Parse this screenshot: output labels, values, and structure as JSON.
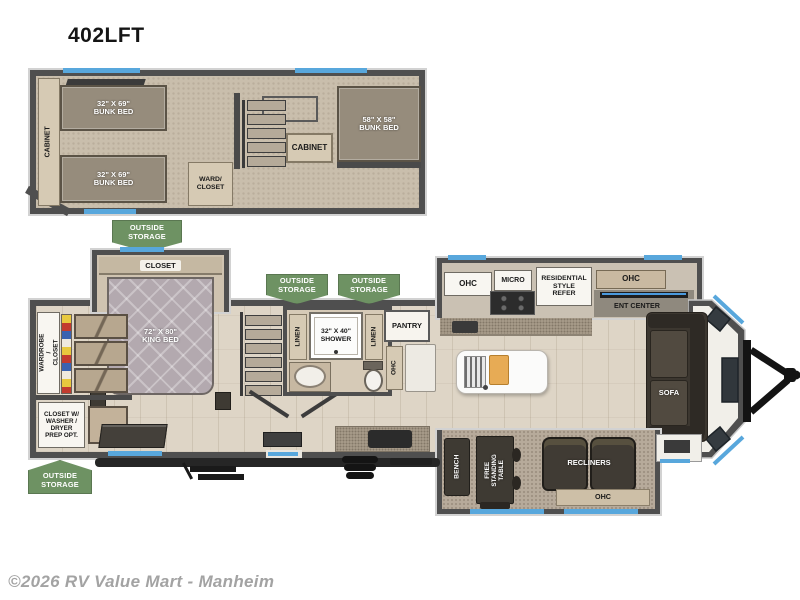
{
  "page": {
    "title": "402LFT",
    "copyright": "©2026 RV Value Mart - Manheim"
  },
  "badges": {
    "outside_storage": "OUTSIDE\nSTORAGE"
  },
  "loft": {
    "cabinet_side": "CABINET",
    "bunk_top": "32\" X 69\"\nBUNK BED",
    "bunk_bottom": "32\" X 69\"\nBUNK BED",
    "ward_closet": "WARD/\nCLOSET",
    "cabinet_mid": "CABINET",
    "bunk_front": "58\" X 58\"\nBUNK BED"
  },
  "main": {
    "closet": "CLOSET",
    "king_bed": "72\" X 80\"\nKING BED",
    "wardrobe_closet": "WARDROBE /\nCLOSET",
    "washer_closet": "CLOSET W/\nWASHER /\nDRYER\nPREP OPT.",
    "linen_left": "LINEN",
    "shower": "32\" X 40\"\nSHOWER",
    "linen_right": "LINEN",
    "pantry": "PANTRY",
    "ohc_bath": "OHC",
    "ohc_kitchen_left": "OHC",
    "micro": "MICRO",
    "refer": "RESIDENTIAL\nSTYLE\nREFER",
    "ohc_kitchen_right": "OHC",
    "ent_center": "ENT CENTER",
    "sofa": "SOFA",
    "bench": "BENCH",
    "free_standing_table": "FREE\nSTANDING\nTABLE",
    "recliners": "RECLINERS",
    "ohc_rear_slide": "OHC"
  },
  "colors": {
    "badge_green": "#6e9263",
    "wall_dark": "#4f4f4f",
    "accent_blue": "#58a7dc",
    "floor_wood": "#ded5c6",
    "carpet": "#c9beac"
  }
}
